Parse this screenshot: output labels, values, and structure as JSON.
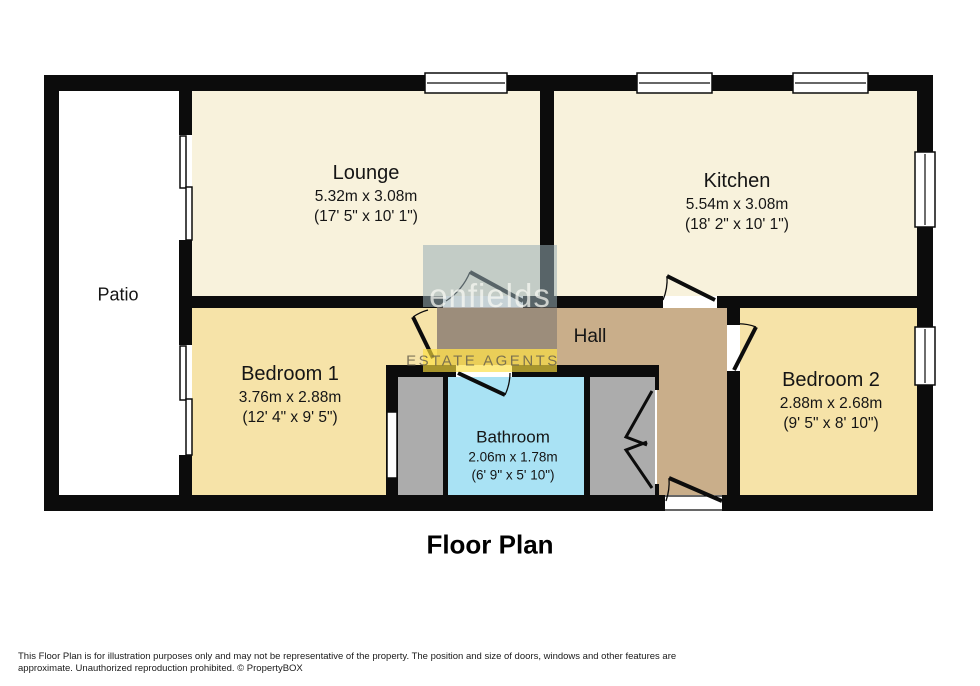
{
  "title": "Floor Plan",
  "watermark": {
    "brand": "enfields",
    "tagline": "ESTATE AGENTS"
  },
  "rooms": {
    "lounge": {
      "name": "Lounge",
      "metric": "5.32m x 3.08m",
      "imperial": "(17' 5\" x 10' 1\")"
    },
    "kitchen": {
      "name": "Kitchen",
      "metric": "5.54m x 3.08m",
      "imperial": "(18' 2\" x 10' 1\")"
    },
    "patio": {
      "name": "Patio"
    },
    "hall": {
      "name": "Hall"
    },
    "bedroom1": {
      "name": "Bedroom 1",
      "metric": "3.76m x 2.88m",
      "imperial": "(12' 4\" x 9' 5\")"
    },
    "bedroom2": {
      "name": "Bedroom 2",
      "metric": "2.88m x 2.68m",
      "imperial": "(9' 5\" x 8' 10\")"
    },
    "bathroom": {
      "name": "Bathroom",
      "metric": "2.06m x 1.78m",
      "imperial": "(6' 9\" x 5' 10\")"
    }
  },
  "disclaimer": "This Floor Plan is for illustration purposes only and may not be representative of the property. The position and size of doors, windows and other features are approximate. Unauthorized reproduction prohibited. © PropertyBOX",
  "colors": {
    "wall": "#0c0c0c",
    "living_area": "#f8f2dc",
    "bedroom": "#f6e3a8",
    "hall": "#c9ae8a",
    "bathroom": "#a9e2f4",
    "closet": "#acacac",
    "patio": "#ffffff",
    "watermark_box_top": "#c3ccc6",
    "watermark_box_mid": "#9b8d7c",
    "watermark_box_bottom": "#eacd58"
  }
}
